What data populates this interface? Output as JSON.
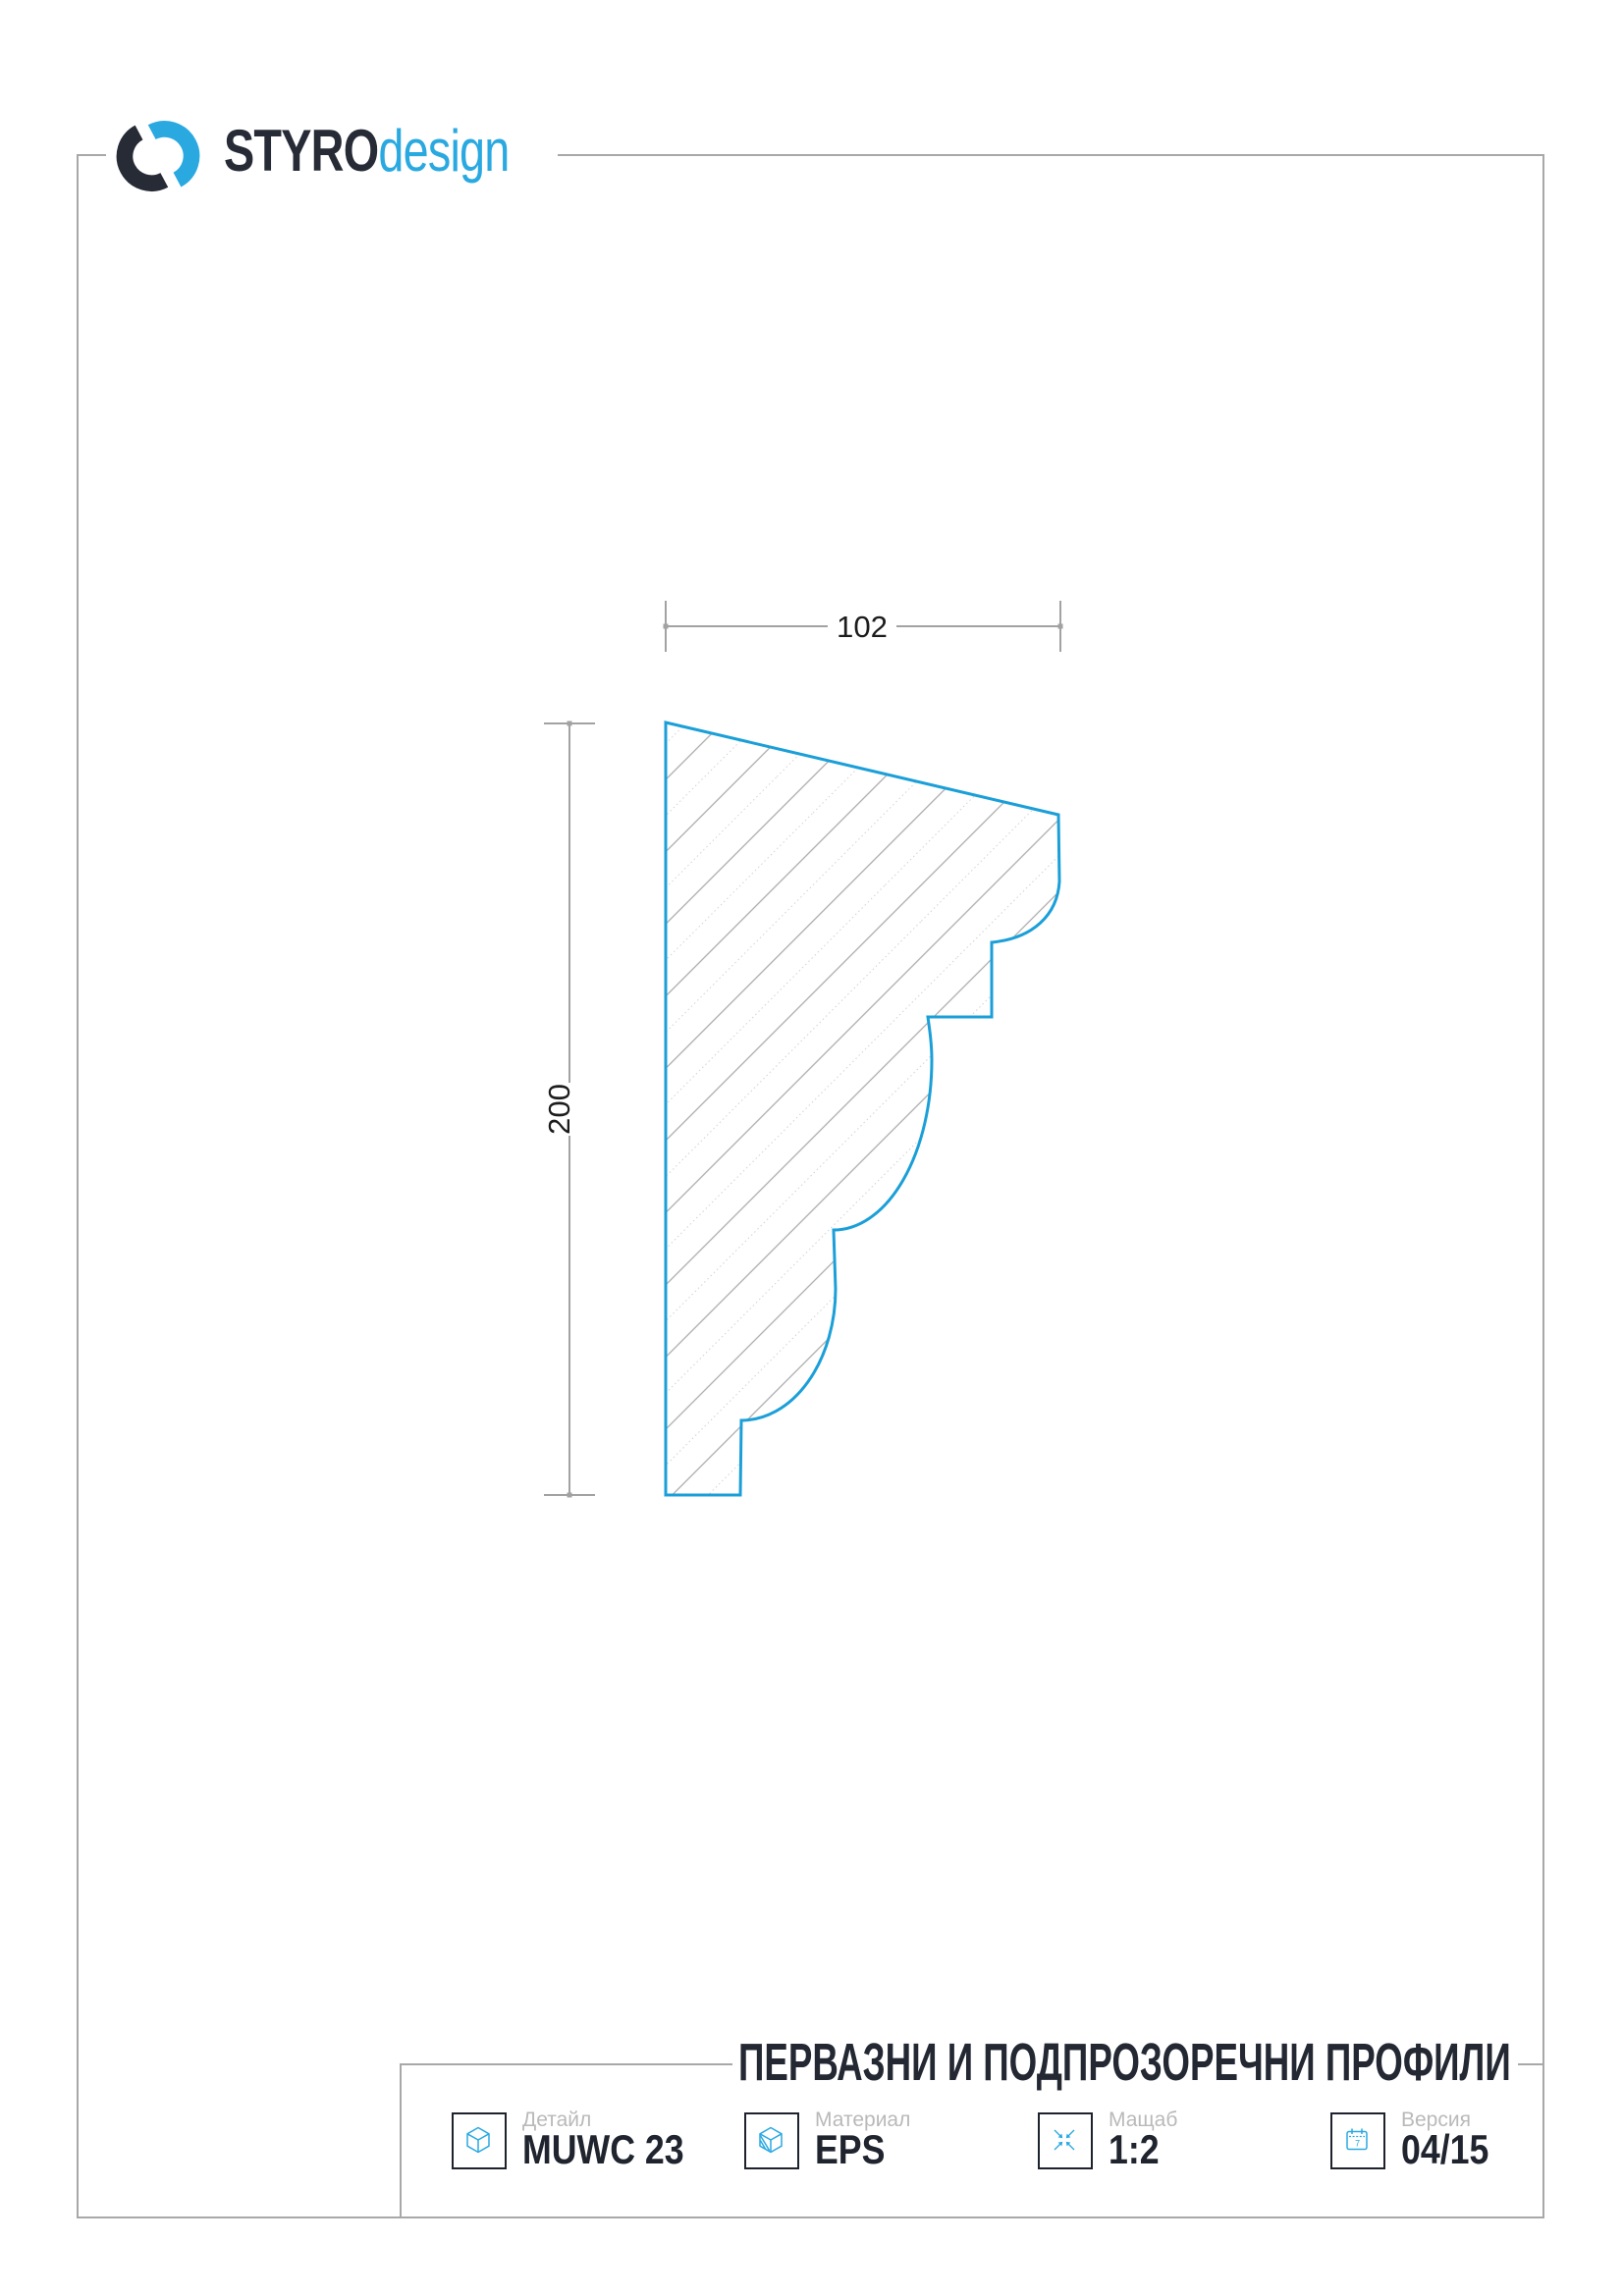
{
  "brand": {
    "name_bold": "STYRO",
    "name_light": "design"
  },
  "drawing": {
    "width_dim": "102",
    "height_dim": "200"
  },
  "title_block": {
    "title": "ПЕРВАЗНИ И ПОДПРОЗОРЕЧНИ ПРОФИЛИ",
    "fields": [
      {
        "label": "Детайл",
        "value": "MUWC 23"
      },
      {
        "label": "Материал",
        "value": "EPS"
      },
      {
        "label": "Мащаб",
        "value": "1:2"
      },
      {
        "label": "Версия",
        "value": "04/15"
      }
    ],
    "calendar_day": "7"
  },
  "colors": {
    "accent_blue": "#2aa9e1",
    "outline_blue": "#1b9fd8",
    "dark_navy": "#232833",
    "frame_gray": "#a8a8a8",
    "dim_gray": "#a2a2a2",
    "label_gray": "#b9b9b9"
  }
}
